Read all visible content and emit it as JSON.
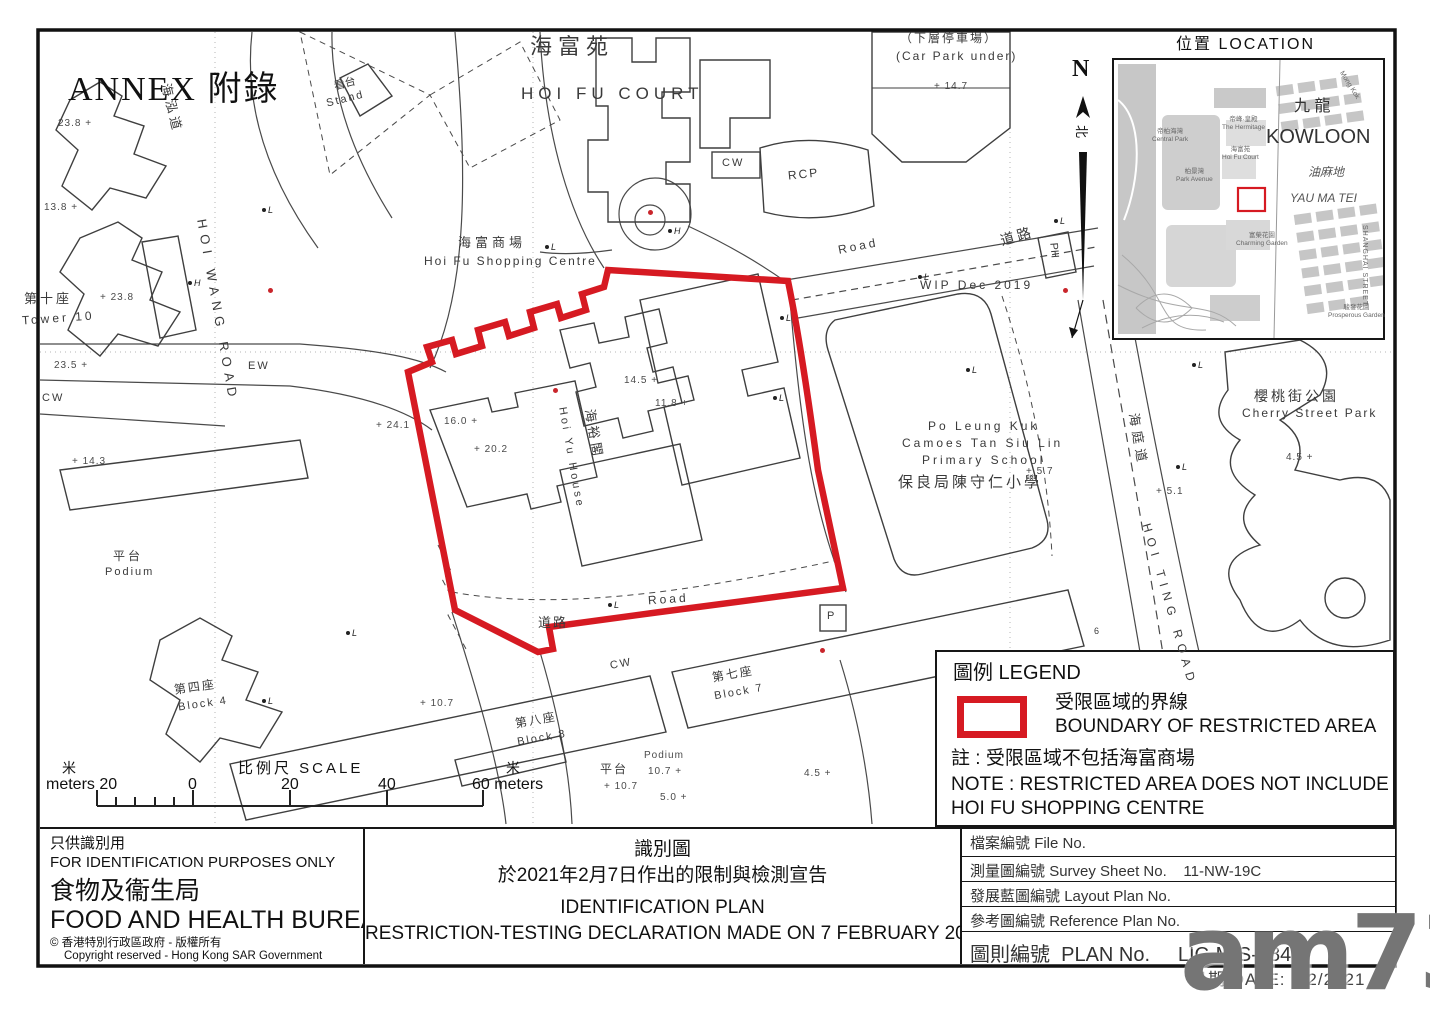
{
  "colors": {
    "boundary": "#d61a22",
    "line": "#3f3f3f",
    "watermark_gray": "#525252"
  },
  "map": {
    "labels": {
      "annex": "ANNEX 附錄",
      "hoifu_cn": "海富苑",
      "hoifu_en": "HOI FU COURT",
      "carpark_cn": "（下層停車場）",
      "carpark_en": "(Car Park under)",
      "stand_cn": "看台",
      "stand_en": "Stand",
      "hoi_wang_road": "HOI WANG ROAD",
      "hoi_wang_cn": "海泓道",
      "shopping_cn": "海富商場",
      "shopping_en": "Hoi Fu Shopping Centre",
      "road_en_top": "Road",
      "road_cn_top": "道路",
      "road_en_mid": "Road",
      "road_cn_mid": "道路",
      "wip": "WIP Dec 2019",
      "rcp": "RCP",
      "cw1": "CW",
      "cw2": "CW",
      "cw3": "CW",
      "ew": "EW",
      "ph": "PH",
      "p": "P",
      "six": "6",
      "tower10_cn": "第十座",
      "tower10_en": "Tower 10",
      "podium1_cn": "平台",
      "podium1_en": "Podium",
      "block4_cn": "第四座",
      "block4_en": "Block 4",
      "block8_cn": "第八座",
      "block8_en": "Block 8",
      "block7_cn": "第七座",
      "block7_en": "Block 7",
      "podium2_cn": "平台",
      "podium2_en": "Podium",
      "school_l1": "Po Leung Kuk",
      "school_l2": "Camoes Tan Siu Lin",
      "school_l3": "Primary School",
      "school_cn": "保良局陳守仁小學",
      "cherry_cn": "櫻桃街公園",
      "cherry_en": "Cherry Street Park",
      "hoi_ting_road": "HOI TING ROAD",
      "hoi_ting_cn": "海庭道",
      "hoiyu_cn": "海裕閣",
      "hoiyu_en": "Hoi Yu House"
    },
    "spot_heights": [
      {
        "v": "23.8 +",
        "x": 58,
        "y": 118
      },
      {
        "v": "13.8 +",
        "x": 44,
        "y": 202
      },
      {
        "v": "+ 23.8",
        "x": 100,
        "y": 292
      },
      {
        "v": "23.5 +",
        "x": 54,
        "y": 360
      },
      {
        "v": "+ 14.3",
        "x": 72,
        "y": 456
      },
      {
        "v": "+ 24.1",
        "x": 376,
        "y": 420
      },
      {
        "v": "16.0 +",
        "x": 444,
        "y": 416
      },
      {
        "v": "+ 20.2",
        "x": 474,
        "y": 444
      },
      {
        "v": "14.5 +",
        "x": 624,
        "y": 375
      },
      {
        "v": "11.8 +",
        "x": 655,
        "y": 398
      },
      {
        "v": "+ 14.7",
        "x": 934,
        "y": 81
      },
      {
        "v": "+ 5.7",
        "x": 1026,
        "y": 466
      },
      {
        "v": "+ 5.1",
        "x": 1156,
        "y": 486
      },
      {
        "v": "4.5 +",
        "x": 1286,
        "y": 452
      },
      {
        "v": "+ 10.7",
        "x": 420,
        "y": 698
      },
      {
        "v": "Podium",
        "x": 644,
        "y": 750
      },
      {
        "v": "10.7 +",
        "x": 648,
        "y": 766
      },
      {
        "v": "+ 10.7",
        "x": 604,
        "y": 781
      },
      {
        "v": "5.0 +",
        "x": 660,
        "y": 792
      },
      {
        "v": "4.5 +",
        "x": 804,
        "y": 768
      }
    ],
    "markers": [
      {
        "t": "L",
        "x": 262,
        "y": 205
      },
      {
        "t": "H",
        "x": 188,
        "y": 278
      },
      {
        "t": "L",
        "x": 545,
        "y": 242
      },
      {
        "t": "H",
        "x": 668,
        "y": 226
      },
      {
        "t": "L",
        "x": 780,
        "y": 313
      },
      {
        "t": "L",
        "x": 918,
        "y": 272
      },
      {
        "t": "L",
        "x": 1054,
        "y": 216
      },
      {
        "t": "L",
        "x": 773,
        "y": 393
      },
      {
        "t": "L",
        "x": 966,
        "y": 365
      },
      {
        "t": "L",
        "x": 1192,
        "y": 360
      },
      {
        "t": "L",
        "x": 1176,
        "y": 462
      },
      {
        "t": "L",
        "x": 346,
        "y": 628
      },
      {
        "t": "L",
        "x": 262,
        "y": 696
      },
      {
        "t": "L",
        "x": 608,
        "y": 600
      }
    ],
    "red_dots": [
      {
        "x": 268,
        "y": 288
      },
      {
        "x": 553,
        "y": 388
      },
      {
        "x": 648,
        "y": 210
      },
      {
        "x": 1063,
        "y": 288
      },
      {
        "x": 820,
        "y": 648
      }
    ]
  },
  "north": {
    "n": "N",
    "cn": "北"
  },
  "inset": {
    "title": "位置 LOCATION",
    "kowloon_cn": "九 龍",
    "kowloon_en": "KOWLOON",
    "ymt_cn": "油麻地",
    "ymt_en": "YAU MA TEI",
    "central_park": "帝柏海灣\nCentral Park",
    "hermitage": "帝峰·皇殿\nThe Hermitage",
    "hoifu": "海富苑\nHoi Fu Court",
    "park_avenue": "柏景灣\nPark Avenue",
    "charming": "富榮花園\nCharming Garden",
    "prosperous": "駿發花園\nProsperous Garden",
    "shanghai": "SHANGHAI STREET",
    "mongkok": "Mong Kok"
  },
  "legend": {
    "title": "圖例 LEGEND",
    "item_cn": "受限區域的界線",
    "item_en": "BOUNDARY OF RESTRICTED AREA",
    "note_cn": "註 : 受限區域不包括海富商場",
    "note_en1": "NOTE : RESTRICTED AREA DOES NOT INCLUDE",
    "note_en2": "HOI FU SHOPPING CENTRE"
  },
  "scale": {
    "title": "比例尺  SCALE",
    "m_left": "米",
    "meters_left": "meters 20",
    "zero": "0",
    "t20": "20",
    "t40": "40",
    "right": "60 meters",
    "m_right": "米"
  },
  "footer": {
    "left": {
      "use_cn": "只供識別用",
      "use_en": "FOR IDENTIFICATION PURPOSES ONLY",
      "bureau_cn": "食物及衞生局",
      "bureau_en": "FOOD AND HEALTH BUREAU",
      "copy_cn": "© 香港特別行政區政府 - 版權所有",
      "copy_en": "Copyright reserved - Hong Kong SAR Government"
    },
    "title": {
      "cn1": "識別圖",
      "cn2": "於2021年2月7日作出的限制與檢測宣告",
      "en1": "IDENTIFICATION PLAN",
      "en2": "RESTRICTION-TESTING DECLARATION MADE ON 7 FEBRUARY 2021"
    },
    "table": {
      "rows": [
        {
          "cn": "檔案編號",
          "en": "File  No.",
          "value": ""
        },
        {
          "cn": "測量圖編號",
          "en": "Survey  Sheet  No.",
          "value": "11-NW-19C"
        },
        {
          "cn": "發展藍圖編號",
          "en": "Layout  Plan  No.",
          "value": ""
        },
        {
          "cn": "參考圖編號",
          "en": "Reference  Plan  No.",
          "value": ""
        }
      ],
      "plan_cn": "圖則編號",
      "plan_en": "PLAN  No.",
      "plan_value": "LIC-MIS-184"
    },
    "date": "日期  DATE:  7/2/2021",
    "watermark": "am730"
  }
}
